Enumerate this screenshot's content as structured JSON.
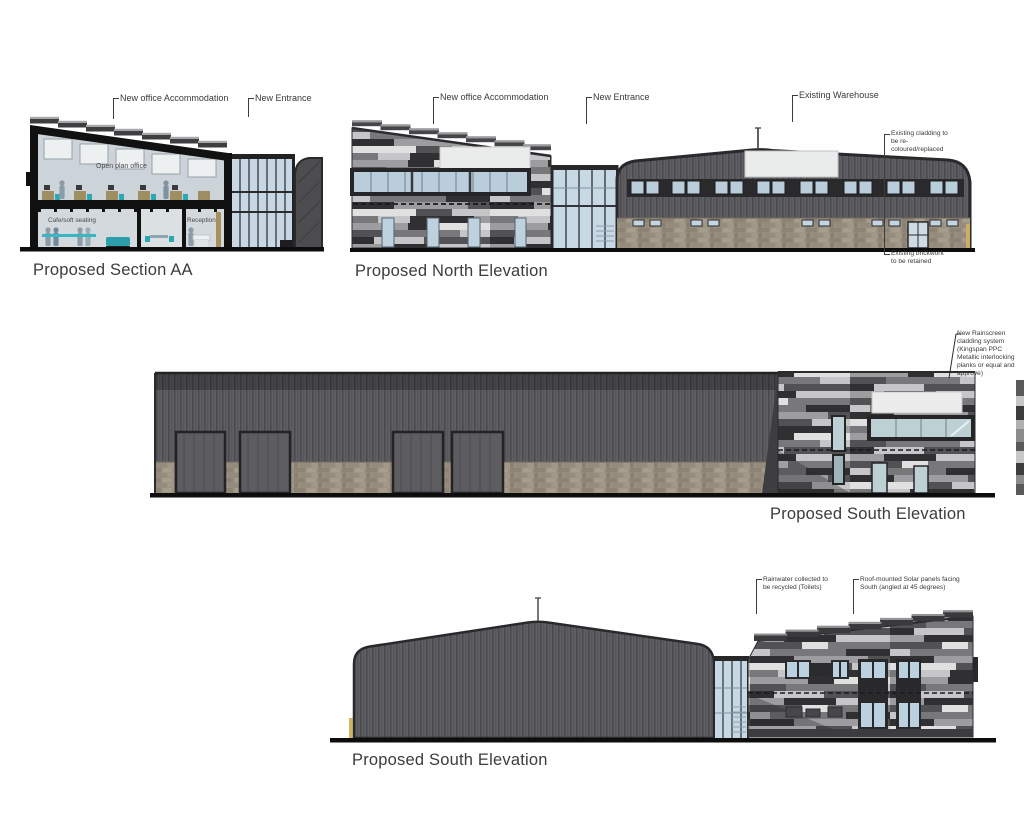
{
  "sheet": {
    "background": "#fefefe"
  },
  "drawings": {
    "section_aa": {
      "title": "Proposed Section AA",
      "labels": {
        "new_office": "New office Accommodation",
        "new_entrance": "New Entrance",
        "open_plan_office": "Open plan office",
        "cafe": "Cafe/soft seating",
        "reception": "Reception"
      }
    },
    "north_elevation": {
      "title": "Proposed North Elevation",
      "labels": {
        "new_office": "New office Accommodation",
        "new_entrance": "New Entrance",
        "existing_warehouse": "Existing Warehouse",
        "cladding_note": "Existing cladding to be re-coloured/replaced",
        "brickwork_note": "Existing brickwork to be retained"
      }
    },
    "south_elevation_long": {
      "title": "Proposed South Elevation",
      "labels": {
        "rainscreen_note": "New Rainscreen cladding system (Kingspan PPC Metallic interlocking planks or equal and approve)"
      }
    },
    "south_elevation_gable": {
      "title": "Proposed South Elevation",
      "labels": {
        "rainwater_note": "Rainwater collected to be recycled (Toilets)",
        "solar_note": "Roof-mounted Solar panels facing South (angled at 45 degrees)"
      }
    }
  },
  "colors": {
    "warehouse_cladding": "#5f5f63",
    "warehouse_band": "#454548",
    "brick": "#9b9183",
    "plank_dark": "#303032",
    "plank_mid": "#9d9da0",
    "plank_light": "#e0e0e1",
    "glass_blue": "#c0d3e0",
    "glass_teal": "#bdd0d3",
    "accent_teal": "#2ba6b2",
    "sign_panel": "#ebeded",
    "ink": "#3a3a3a"
  }
}
